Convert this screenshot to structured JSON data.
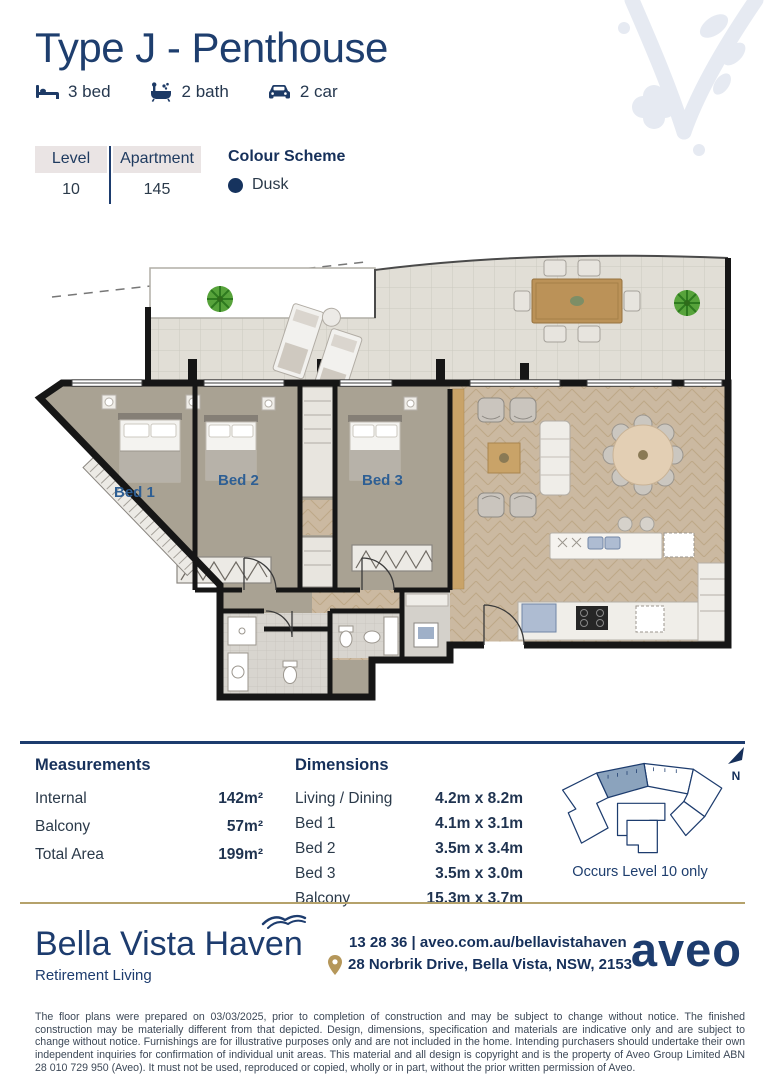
{
  "accents": {
    "navy": "#1d3c6e",
    "gold": "#b5a26b",
    "plan_label_blue": "#2e5f94",
    "dusk_dot": "#16335e"
  },
  "header": {
    "title": "Type J - Penthouse"
  },
  "features": [
    {
      "icon": "bed-icon",
      "label": "3 bed"
    },
    {
      "icon": "bath-icon",
      "label": "2 bath"
    },
    {
      "icon": "car-icon",
      "label": "2 car"
    }
  ],
  "unit": {
    "level_label": "Level",
    "level_value": "10",
    "apartment_label": "Apartment",
    "apartment_value": "145",
    "colour_scheme_label": "Colour Scheme",
    "colour_scheme_value": "Dusk"
  },
  "floor_plan": {
    "bed1_label": "Bed 1",
    "bed2_label": "Bed 2",
    "bed3_label": "Bed 3"
  },
  "measurements": {
    "heading": "Measurements",
    "rows": [
      {
        "label": "Internal",
        "value": "142m²"
      },
      {
        "label": "Balcony",
        "value": "57m²"
      },
      {
        "label": "Total Area",
        "value": "199m²"
      }
    ]
  },
  "dimensions": {
    "heading": "Dimensions",
    "rows": [
      {
        "label": "Living / Dining",
        "value": "4.2m x 8.2m"
      },
      {
        "label": "Bed 1",
        "value": "4.1m x 3.1m"
      },
      {
        "label": "Bed 2",
        "value": "3.5m x 3.4m"
      },
      {
        "label": "Bed 3",
        "value": "3.5m x 3.0m"
      },
      {
        "label": "Balcony",
        "value": "15.3m x 3.7m"
      }
    ]
  },
  "key_plan": {
    "caption": "Occurs Level 10 only",
    "north_label": "N"
  },
  "footer": {
    "brand_name": "Bella Vista Haven",
    "brand_tagline": "Retirement Living",
    "contact_line1": "13 28 36 | aveo.com.au/bellavistahaven",
    "contact_line2": "28 Norbrik Drive, Bella Vista, NSW, 2153",
    "logo_text": "aveo"
  },
  "disclaimer": "The floor plans were prepared on 03/03/2025, prior to completion of construction and may be subject to change without notice. The finished construction may be materially different from that depicted. Design, dimensions, specification and materials are indicative only and are subject to change without notice. Furnishings are for illustrative purposes only and are not included in the home. Intending purchasers should undertake their own independent inquiries for confirmation of individual unit areas. This material and all design is copyright and is the property of Aveo Group Limited ABN 28 010 729 950 (Aveo). It must not be used, reproduced or copied, wholly or in part, without the prior written permission of Aveo."
}
